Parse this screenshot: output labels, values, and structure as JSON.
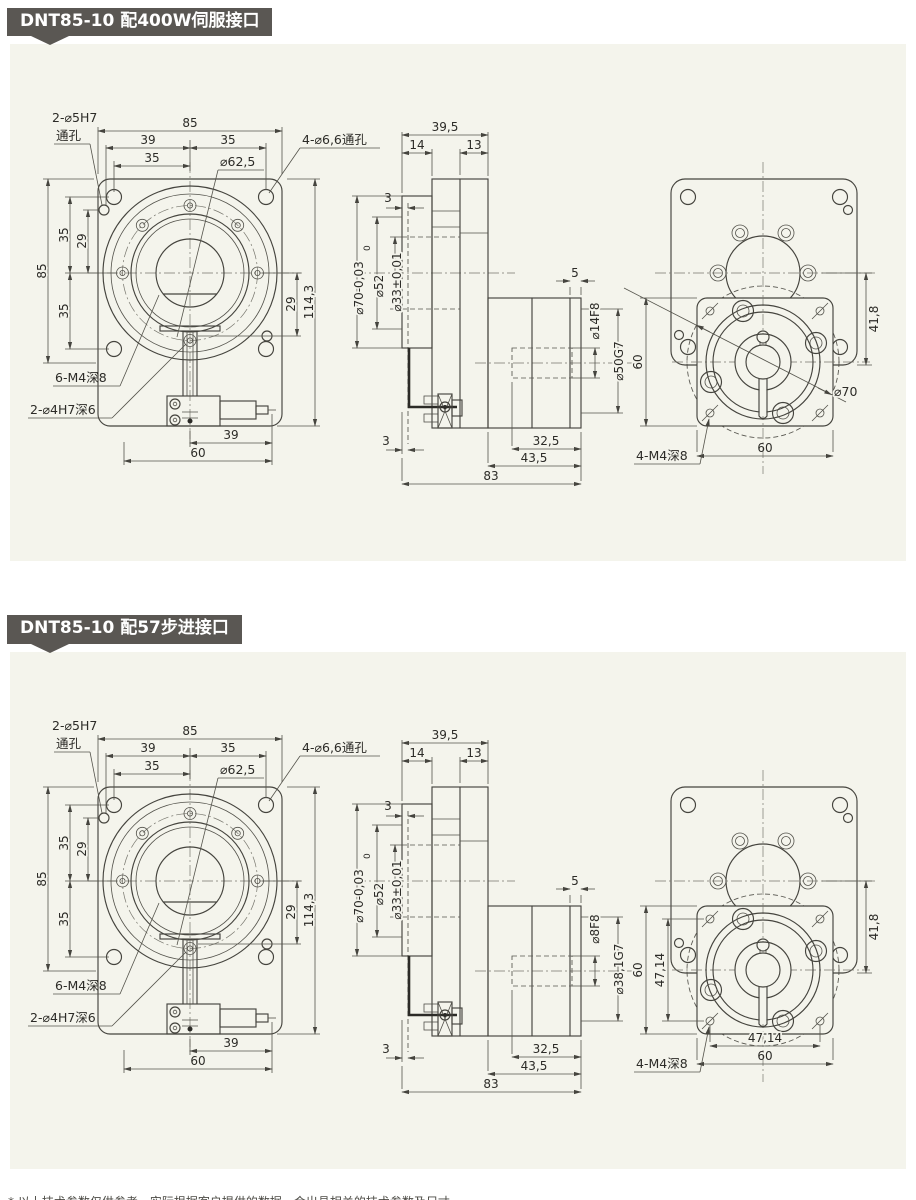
{
  "page": {
    "background": "#ffffff",
    "panel_bg": "#f4f4ec",
    "badge_bg": "#5a5753",
    "badge_text_color": "#ffffff",
    "line_color": "#45443e"
  },
  "footnote": "* 以上技术参数仅供参考，实际根据客户提供的数据，会出具相关的技术参数及尺寸。",
  "sections": [
    {
      "badge": "DNT85-10 配400W伺服接口",
      "front": {
        "lbl_pin_qty": "2-⌀5H7",
        "lbl_pin_type": "通孔",
        "lbl_corner": "4-⌀6,6通孔",
        "lbl_bc": "⌀62,5",
        "lbl_m4": "6-M4深8",
        "lbl_dowel": "2-⌀4H7深6",
        "d_top": "85",
        "d_top_l": "39",
        "d_top_r": "35",
        "d_top_l2": "35",
        "d_left": "85",
        "d_left_u": "35",
        "d_left_m": "29",
        "d_left_d": "35",
        "d_right": "29",
        "d_height": "114,3",
        "d_bot": "39",
        "d_bot2": "60"
      },
      "side": {
        "d_depth": "39,5",
        "d_front": "14",
        "d_rear": "13",
        "d_step_t": "3",
        "d_step_b": "3",
        "d_boss": "⌀70-0,03",
        "d_boss_sup": "0",
        "d_spigot": "⌀52",
        "d_bore": "⌀33±0,01",
        "d_shaft": "5",
        "d_mbore": "⌀14F8",
        "d_pilot": "⌀50G7",
        "d_rear_len": "32,5",
        "d_motor_len": "43,5",
        "d_total": "83"
      },
      "rear": {
        "lbl_m4": "4-M4深8",
        "lbl_boss": "⌀70",
        "show_boss": true,
        "d_h": "60",
        "d_offset": "41,8",
        "d_w": "60",
        "d_pitch_v": "",
        "d_pitch_h": "",
        "show_pitch": false
      }
    },
    {
      "badge": "DNT85-10 配57步进接口",
      "front": {
        "lbl_pin_qty": "2-⌀5H7",
        "lbl_pin_type": "通孔",
        "lbl_corner": "4-⌀6,6通孔",
        "lbl_bc": "⌀62,5",
        "lbl_m4": "6-M4深8",
        "lbl_dowel": "2-⌀4H7深6",
        "d_top": "85",
        "d_top_l": "39",
        "d_top_r": "35",
        "d_top_l2": "35",
        "d_left": "85",
        "d_left_u": "35",
        "d_left_m": "29",
        "d_left_d": "35",
        "d_right": "29",
        "d_height": "114,3",
        "d_bot": "39",
        "d_bot2": "60"
      },
      "side": {
        "d_depth": "39,5",
        "d_front": "14",
        "d_rear": "13",
        "d_step_t": "3",
        "d_step_b": "3",
        "d_boss": "⌀70-0,03",
        "d_boss_sup": "0",
        "d_spigot": "⌀52",
        "d_bore": "⌀33±0,01",
        "d_shaft": "5",
        "d_mbore": "⌀8F8",
        "d_pilot": "⌀38,1G7",
        "d_rear_len": "32,5",
        "d_motor_len": "43,5",
        "d_total": "83"
      },
      "rear": {
        "lbl_m4": "4-M4深8",
        "lbl_boss": "",
        "show_boss": false,
        "d_h": "60",
        "d_offset": "41,8",
        "d_w": "60",
        "d_pitch_v": "47,14",
        "d_pitch_h": "47,14",
        "show_pitch": true
      }
    }
  ]
}
